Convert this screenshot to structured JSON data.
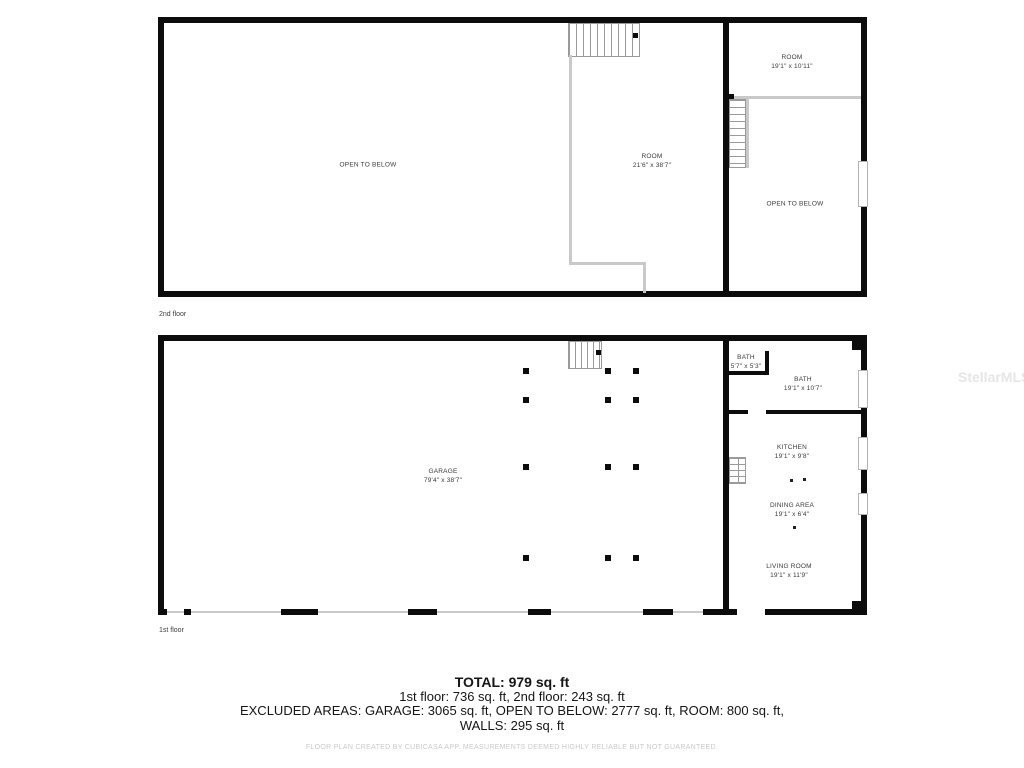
{
  "watermark": "StellarMLS",
  "floors": [
    {
      "label": "2nd floor",
      "rooms": [
        {
          "name": "OPEN TO BELOW",
          "dims": ""
        },
        {
          "name": "ROOM",
          "dims": "21'6\" x 38'7\""
        },
        {
          "name": "ROOM",
          "dims": "19'1\" x 10'11\""
        },
        {
          "name": "OPEN TO BELOW",
          "dims": ""
        }
      ]
    },
    {
      "label": "1st floor",
      "rooms": [
        {
          "name": "GARAGE",
          "dims": "79'4\" x 38'7\""
        },
        {
          "name": "BATH",
          "dims": "5'7\" x 5'3\""
        },
        {
          "name": "BATH",
          "dims": "19'1\" x 10'7\""
        },
        {
          "name": "KITCHEN",
          "dims": "19'1\" x 9'8\""
        },
        {
          "name": "DINING AREA",
          "dims": "19'1\" x 6'4\""
        },
        {
          "name": "LIVING ROOM",
          "dims": "19'1\" x 11'9\""
        }
      ]
    }
  ],
  "summary": {
    "total": "TOTAL: 979 sq. ft",
    "floors_line": "1st floor: 736 sq. ft, 2nd floor: 243 sq. ft",
    "excluded_line": "EXCLUDED AREAS: GARAGE: 3065 sq. ft, OPEN TO BELOW: 2777 sq. ft, ROOM: 800 sq. ft,",
    "walls_line": "WALLS: 295 sq. ft"
  },
  "footer": "FLOOR PLAN CREATED BY CUBICASA APP. MEASUREMENTS DEEMED HIGHLY RELIABLE BUT NOT GUARANTEED.",
  "colors": {
    "wall": "#0c0c0c",
    "thin_wall": "#c9c9c9",
    "stair_line": "#9a9a9a",
    "label_text": "#3a3a3a",
    "summary_text": "#151515",
    "footer_text": "#c9c9c9",
    "watermark_text": "#e6e6e6"
  }
}
